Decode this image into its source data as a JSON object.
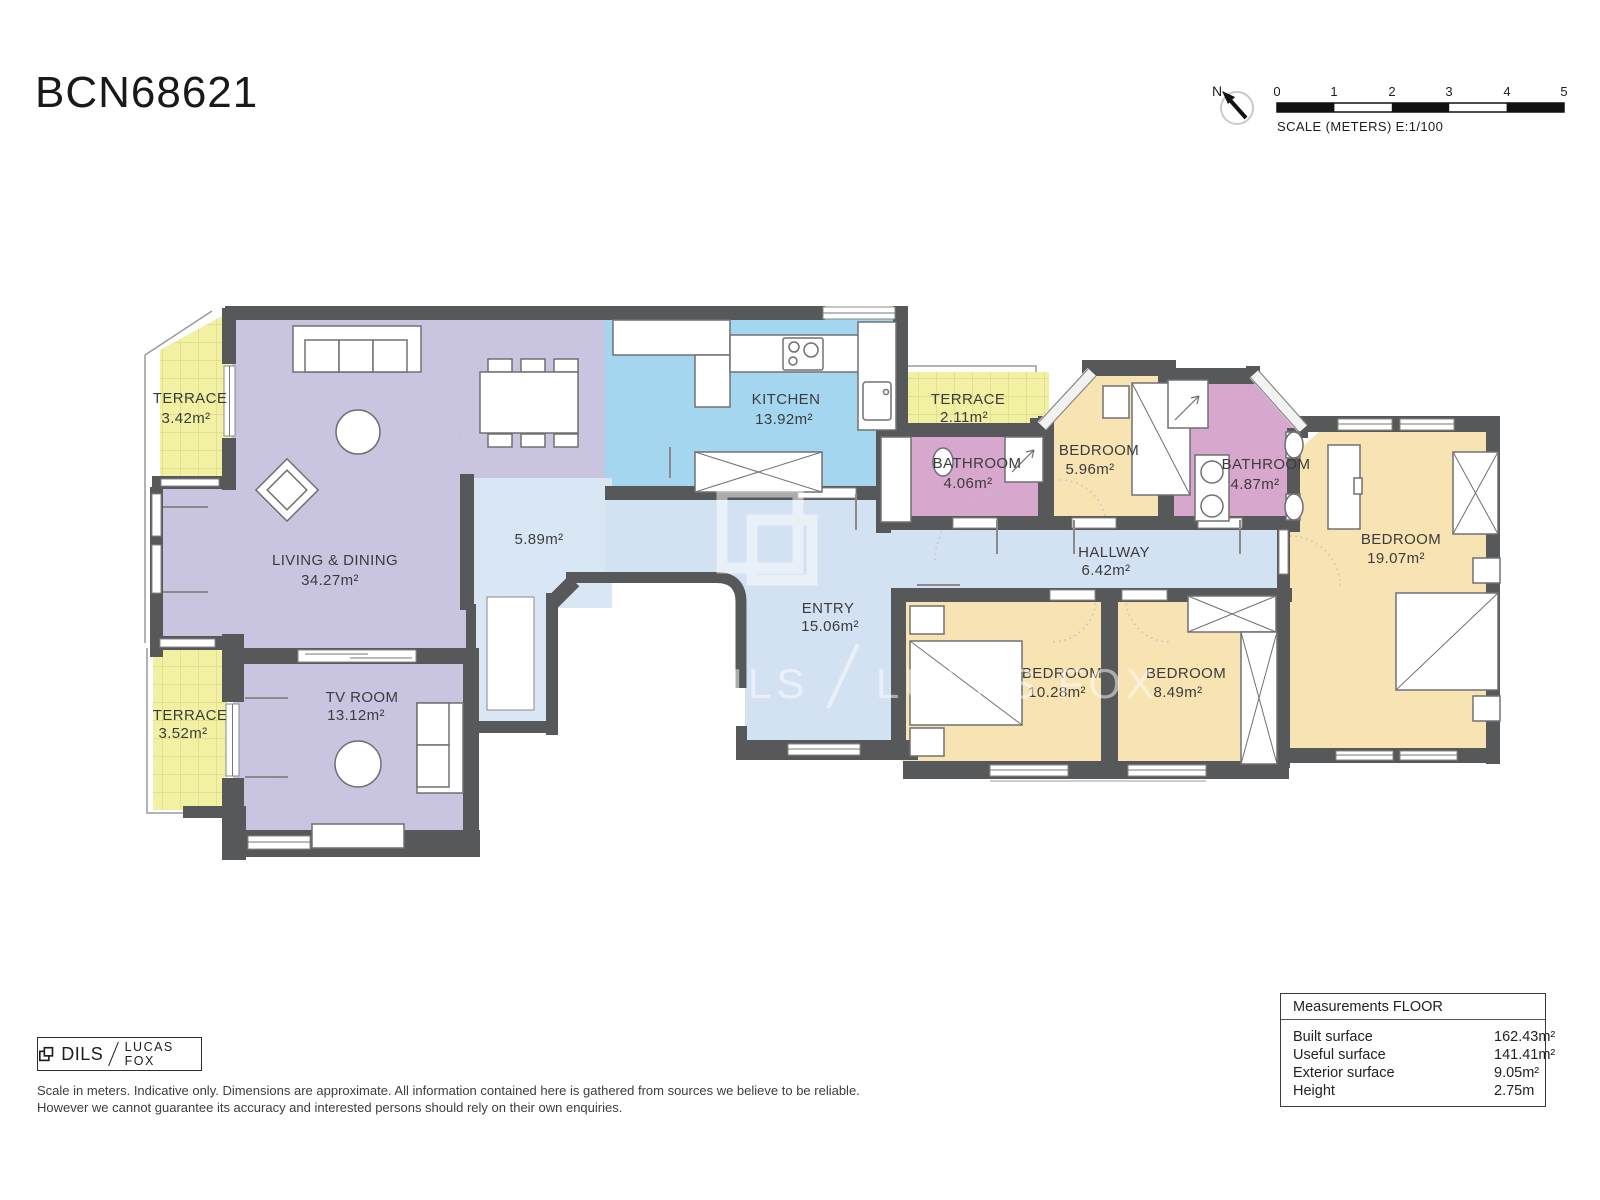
{
  "title": "BCN68621",
  "compass": {
    "north_label": "N"
  },
  "scale_bar": {
    "ticks": [
      "0",
      "1",
      "2",
      "3",
      "4",
      "5"
    ],
    "label": "SCALE (METERS) E:1/100"
  },
  "rooms": [
    {
      "name": "TERRACE",
      "area": "3.42m²"
    },
    {
      "name": "LIVING & DINING",
      "area": "34.27m²"
    },
    {
      "name": "KITCHEN",
      "area": "13.92m²"
    },
    {
      "name": "",
      "area": "5.89m²"
    },
    {
      "name": "TERRACE",
      "area": "2.11m²"
    },
    {
      "name": "BATHROOM",
      "area": "4.06m²"
    },
    {
      "name": "BEDROOM",
      "area": "5.96m²"
    },
    {
      "name": "BATHROOM",
      "area": "4.87m²"
    },
    {
      "name": "BEDROOM",
      "area": "19.07m²"
    },
    {
      "name": "HALLWAY",
      "area": "6.42m²"
    },
    {
      "name": "ENTRY",
      "area": "15.06m²"
    },
    {
      "name": "BEDROOM",
      "area": "10.28m²"
    },
    {
      "name": "BEDROOM",
      "area": "8.49m²"
    },
    {
      "name": "TV ROOM",
      "area": "13.12m²"
    },
    {
      "name": "TERRACE",
      "area": "3.52m²"
    }
  ],
  "watermark": {
    "brand_left": "DILS",
    "brand_right": "LUCAS FOX"
  },
  "footer": {
    "logo": {
      "dils": "DILS",
      "lucas_fox": "LUCAS FOX"
    },
    "disclaimer_line1": "Scale in meters. Indicative only. Dimensions are approximate. All information contained here is gathered from sources we believe to be reliable.",
    "disclaimer_line2": "However we cannot guarantee its accuracy and interested persons should rely on their own enquiries."
  },
  "measurements": {
    "title": "Measurements FLOOR",
    "rows": [
      {
        "label": "Built surface",
        "value": "162.43m²"
      },
      {
        "label": "Useful surface",
        "value": "141.41m²"
      },
      {
        "label": "Exterior surface",
        "value": "9.05m²"
      },
      {
        "label": "Height",
        "value": "2.75m"
      }
    ]
  },
  "colors": {
    "wall": "#57585a",
    "living": "#c9c4e0",
    "kitchen": "#a5d6f0",
    "circulation": "#d3e2f2",
    "bedroom": "#f8e4b3",
    "bathroom": "#d7a7cd",
    "terrace": "#f2f0a2"
  }
}
